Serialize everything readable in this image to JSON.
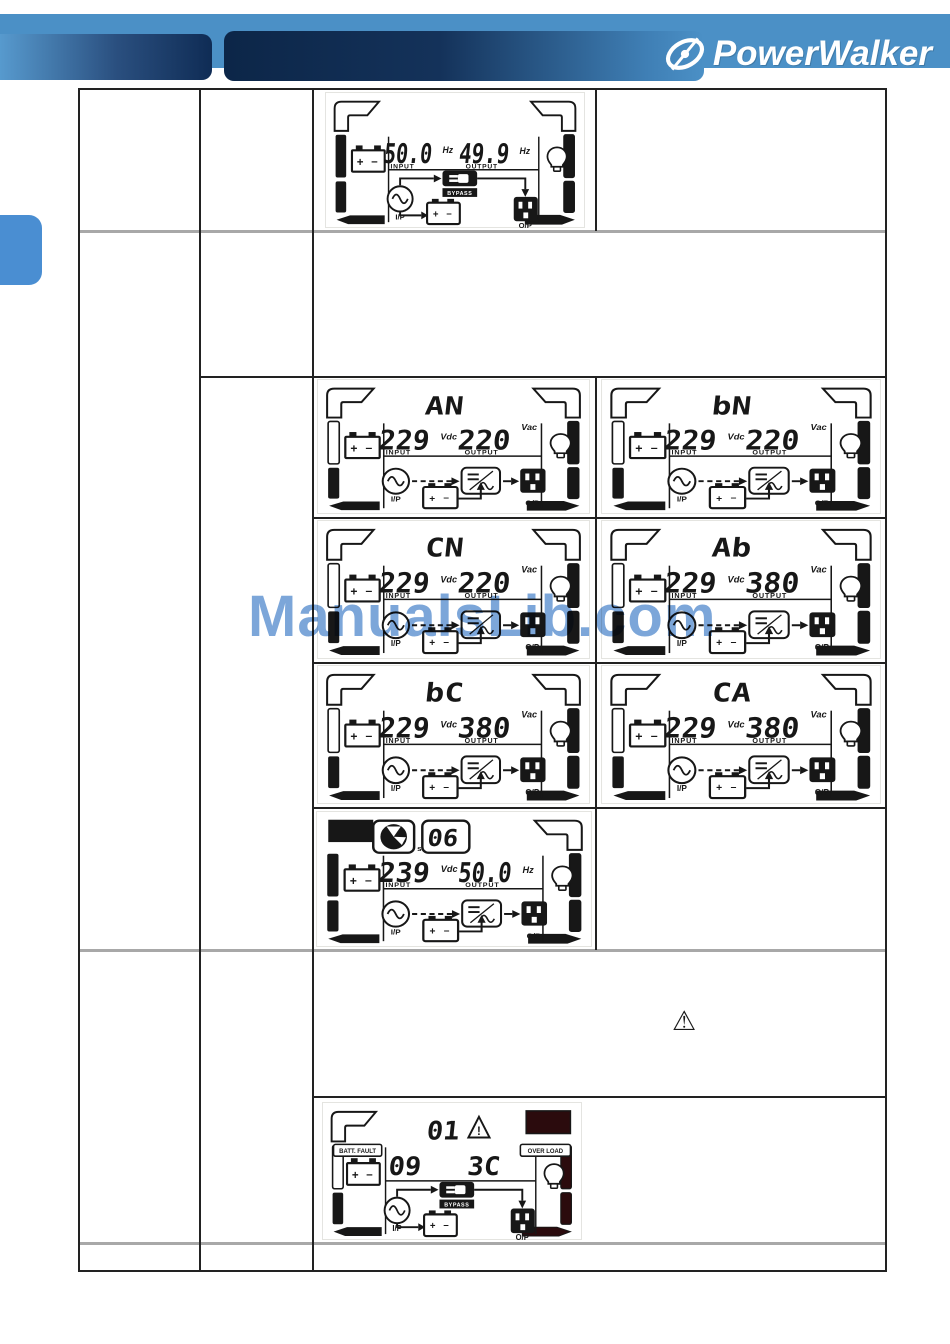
{
  "header": {
    "brand": "PowerWalker"
  },
  "watermark": {
    "text": "ManualsLib.com"
  },
  "icons": {
    "warning": "⚠"
  },
  "lcd_labels": {
    "input": "INPUT",
    "output": "OUTPUT",
    "ip": "I/P",
    "op": "O/P",
    "bypass": "BYPASS",
    "seconds": "s"
  },
  "displays": {
    "bypass_frequency": {
      "type": "bypass",
      "input": "50.0",
      "input_unit": "Hz",
      "output": "49.9",
      "output_unit": "Hz"
    },
    "modes": [
      {
        "type": "mode",
        "mode": "AN",
        "input": "229",
        "input_unit": "Vdc",
        "output": "220",
        "output_unit": "Vac"
      },
      {
        "type": "mode",
        "mode": "bN",
        "input": "229",
        "input_unit": "Vdc",
        "output": "220",
        "output_unit": "Vac"
      },
      {
        "type": "mode",
        "mode": "CN",
        "input": "229",
        "input_unit": "Vdc",
        "output": "220",
        "output_unit": "Vac"
      },
      {
        "type": "mode",
        "mode": "Ab",
        "input": "229",
        "input_unit": "Vdc",
        "output": "380",
        "output_unit": "Vac"
      },
      {
        "type": "mode",
        "mode": "bC",
        "input": "229",
        "input_unit": "Vdc",
        "output": "380",
        "output_unit": "Vac"
      },
      {
        "type": "mode",
        "mode": "CA",
        "input": "229",
        "input_unit": "Vdc",
        "output": "380",
        "output_unit": "Vac"
      }
    ],
    "timer": {
      "type": "timer",
      "countdown": "06",
      "input": "239",
      "input_unit": "Vdc",
      "output": "50.0",
      "output_unit": "Hz"
    },
    "fault": {
      "type": "fault",
      "top_code": "01",
      "left_code": "09",
      "right_code": "3C",
      "left_label": "BATT. FAULT",
      "right_label": "OVER LOAD"
    }
  }
}
